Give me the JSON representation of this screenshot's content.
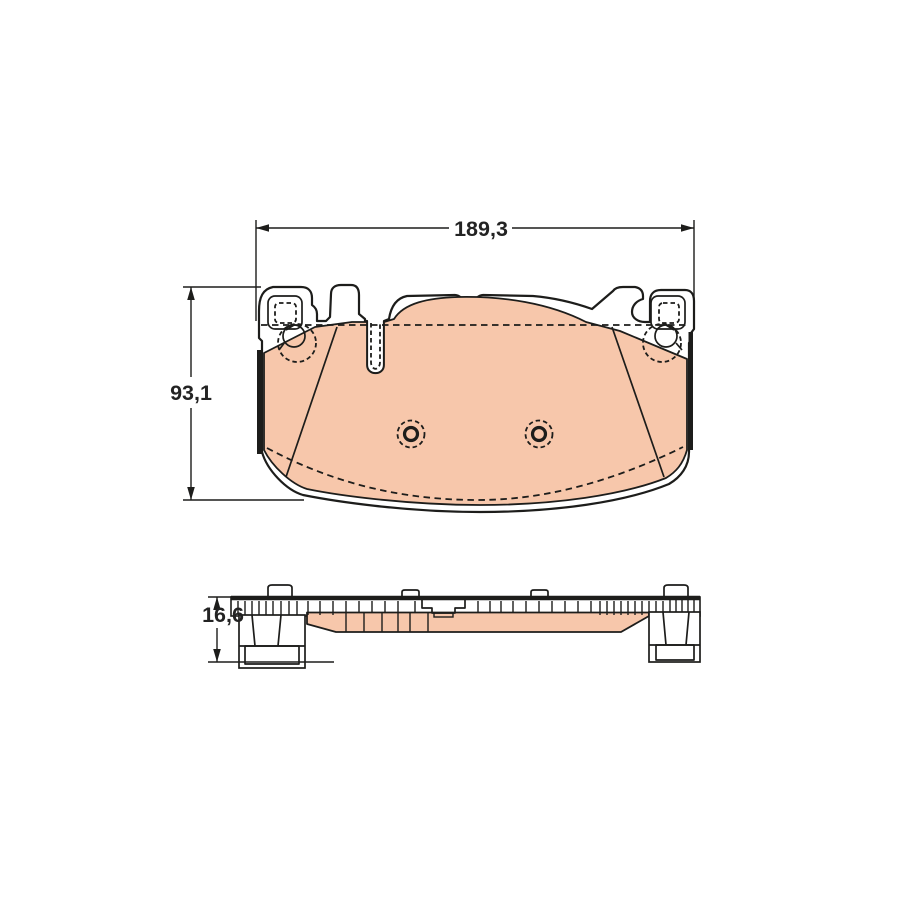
{
  "drawing": {
    "dimensions": {
      "width": "189,3",
      "height": "93,1",
      "thickness": "16,6"
    },
    "colors": {
      "friction_material": "#f7c7ab",
      "line": "#1d1d1b",
      "background": "#ffffff"
    }
  }
}
